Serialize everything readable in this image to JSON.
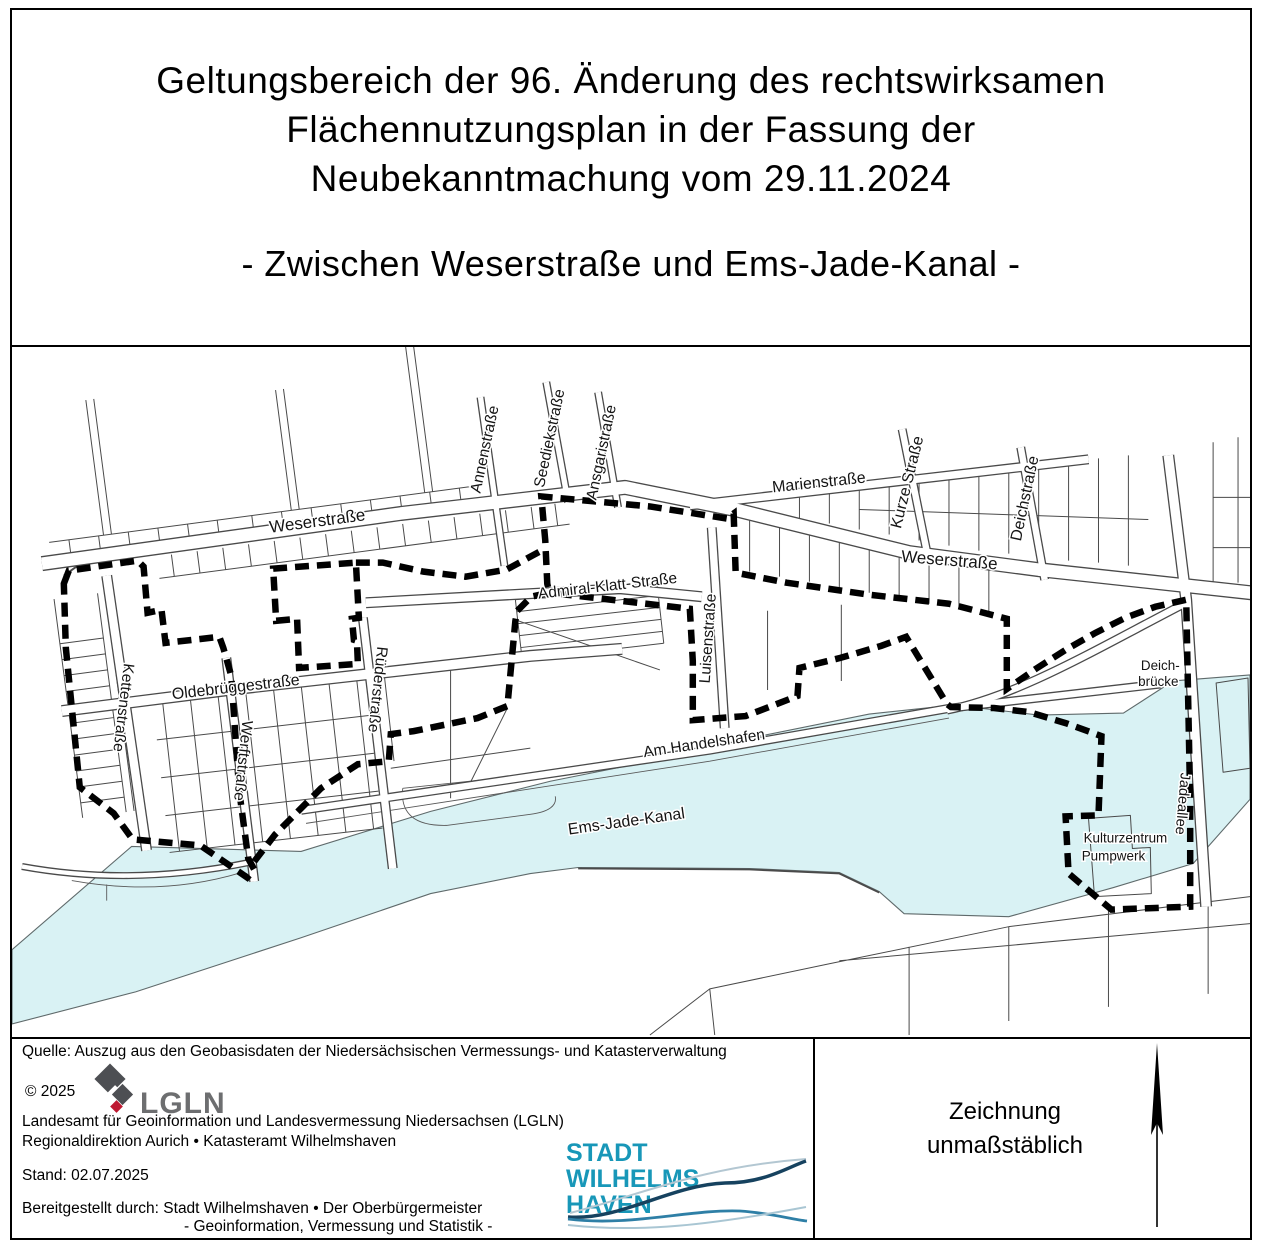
{
  "title": {
    "line1": "Geltungsbereich der 96. Änderung des rechtswirksamen",
    "line2": "Flächennutzungsplan in der Fassung der",
    "line3": "Neubekanntmachung vom 29.11.2024",
    "subtitle": "- Zwischen Weserstraße und Ems-Jade-Kanal -"
  },
  "map": {
    "labels": {
      "weserstrasse_west": "Weserstraße",
      "weserstrasse_east": "Weserstraße",
      "marienstrasse": "Marienstraße",
      "kurze_strasse": "Kurze Straße",
      "deichstrasse": "Deichstraße",
      "annenstrasse": "Annenstraße",
      "seediekstrasse": "Seediekstraße",
      "ansgaristrasse": "Ansgaristraße",
      "admiral_klatt_strasse": "Admiral-Klatt-Straße",
      "luisenstrasse": "Luisenstraße",
      "oldebrueggestrasse": "Oldebrüggestraße",
      "kettenstrasse": "Kettenstraße",
      "werftstrasse": "Werftstraße",
      "ruederstrasse": "Rüderstraße",
      "am_handelshafen": "Am Handelshafen",
      "ems_jade_kanal": "Ems-Jade-Kanal",
      "deichbruecke_line1": "Deich-",
      "deichbruecke_line2": "brücke",
      "jadeallee": "Jadeallee",
      "kulturzentrum_line1": "Kulturzentrum",
      "kulturzentrum_line2": "Pumpwerk"
    },
    "colors": {
      "water": "#d9f2f4",
      "boundary": "#000000",
      "parcel_line": "#4a4a4a"
    }
  },
  "footer": {
    "source_line": "Quelle: Auszug aus den Geobasisdaten der Niedersächsischen Vermessungs- und Katasterverwaltung",
    "copyright": "© 2025",
    "lgln_logo_text": "LGLN",
    "agency_line1": "Landesamt für Geoinformation und Landesvermessung Niedersachsen (LGLN)",
    "agency_line2": "Regionaldirektion Aurich • Katasteramt Wilhelmshaven",
    "date_line": "Stand: 02.07.2025",
    "provided_line1": "Bereitgestellt durch: Stadt Wilhelmshaven • Der Oberbürgermeister",
    "provided_line2": "- Geoinformation, Vermessung und Statistik -",
    "city_logo": {
      "line1": "STADT",
      "line2": "WILHELMS",
      "line3": "HAVEN",
      "color": "#1897b8"
    }
  },
  "legend": {
    "note_line1": "Zeichnung",
    "note_line2": "unmaßstäblich"
  }
}
